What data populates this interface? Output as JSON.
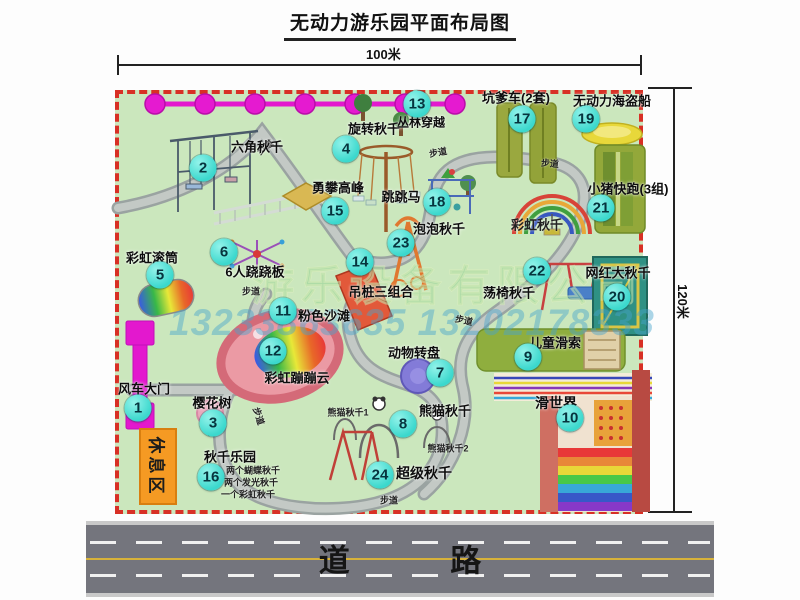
{
  "title": "无动力游乐园平面布局图",
  "dim": {
    "width": "100米",
    "height": "120米"
  },
  "road_label": "道 路",
  "rest_area_label": "休息区",
  "watermark": {
    "company": "游乐设备有限公司",
    "phone": "13233863635 13202178333"
  },
  "colors": {
    "map_bg": "#cbe7bd",
    "border_red": "#d83025",
    "badge": "#3bd8cd",
    "magenta": "#e318ce",
    "road": "#74757d",
    "rest_orange": "#f59a23",
    "path_gray": "#9aa3a1"
  },
  "markers": [
    {
      "num": "1",
      "name": "风车大门",
      "bx": 138,
      "by": 408,
      "lx": 144,
      "ly": 388
    },
    {
      "num": "2",
      "name": "六角秋千",
      "bx": 203,
      "by": 168,
      "lx": 257,
      "ly": 146
    },
    {
      "num": "3",
      "name": "樱花树",
      "bx": 213,
      "by": 423,
      "lx": 212,
      "ly": 402
    },
    {
      "num": "4",
      "name": "旋转秋千",
      "bx": 346,
      "by": 149,
      "lx": 374,
      "ly": 128
    },
    {
      "num": "5",
      "name": "彩虹滚筒",
      "bx": 160,
      "by": 275,
      "lx": 152,
      "ly": 257
    },
    {
      "num": "6",
      "name": "6人跷跷板",
      "bx": 224,
      "by": 252,
      "lx": 255,
      "ly": 271
    },
    {
      "num": "7",
      "name": "动物转盘",
      "bx": 440,
      "by": 373,
      "lx": 414,
      "ly": 352
    },
    {
      "num": "8",
      "name": "熊猫秋千",
      "bx": 403,
      "by": 424,
      "lx": 445,
      "ly": 410
    },
    {
      "num": "9",
      "name": "儿童滑索",
      "bx": 528,
      "by": 357,
      "lx": 555,
      "ly": 342
    },
    {
      "num": "10",
      "name": "滑世界",
      "bx": 570,
      "by": 418,
      "lx": 556,
      "ly": 403,
      "fs": 14
    },
    {
      "num": "11",
      "name": "粉色沙滩",
      "bx": 283,
      "by": 311,
      "lx": 324,
      "ly": 315
    },
    {
      "num": "12",
      "name": "彩虹蹦蹦云",
      "bx": 273,
      "by": 351,
      "lx": 297,
      "ly": 377
    },
    {
      "num": "13",
      "name": "丛林穿越",
      "bx": 417,
      "by": 104,
      "lx": 421,
      "ly": 122,
      "fs": 12
    },
    {
      "num": "14",
      "name": "吊桩三组合",
      "bx": 360,
      "by": 262,
      "lx": 381,
      "ly": 291
    },
    {
      "num": "15",
      "name": "勇攀高峰",
      "bx": 335,
      "by": 211,
      "lx": 338,
      "ly": 187
    },
    {
      "num": "16",
      "name": "秋千乐园",
      "bx": 211,
      "by": 477,
      "lx": 230,
      "ly": 456
    },
    {
      "num": "17",
      "name": "坑爹车(2套)",
      "bx": 522,
      "by": 119,
      "lx": 516,
      "ly": 97
    },
    {
      "num": "18",
      "name": "跳跳马",
      "bx": 437,
      "by": 202,
      "lx": 401,
      "ly": 196
    },
    {
      "num": "19",
      "name": "无动力海盗船",
      "bx": 586,
      "by": 119,
      "lx": 612,
      "ly": 100
    },
    {
      "num": "20",
      "name": "网红大秋千",
      "bx": 617,
      "by": 297,
      "lx": 618,
      "ly": 272
    },
    {
      "num": "21",
      "name": "小猪快跑(3组)",
      "bx": 601,
      "by": 208,
      "lx": 628,
      "ly": 188
    },
    {
      "num": "22",
      "name": "荡椅秋千",
      "bx": 537,
      "by": 271,
      "lx": 509,
      "ly": 292
    },
    {
      "num": "23",
      "name": "泡泡秋千",
      "bx": 401,
      "by": 243,
      "lx": 439,
      "ly": 228
    },
    {
      "num": "24",
      "name": "超级秋千",
      "bx": 380,
      "by": 475,
      "lx": 424,
      "ly": 473,
      "fs": 14
    }
  ],
  "labels": [
    {
      "text": "彩虹秋千",
      "x": 537,
      "y": 224,
      "fs": 13,
      "name": "label-rainbow-swing"
    },
    {
      "text": "熊猫秋千1",
      "x": 348,
      "y": 412,
      "fs": 9,
      "name": "label-panda-swing-1"
    },
    {
      "text": "熊猫秋千2",
      "x": 448,
      "y": 448,
      "fs": 9,
      "name": "label-panda-swing-2"
    },
    {
      "text": "两个蝴蝶秋千",
      "x": 253,
      "y": 470,
      "fs": 9,
      "name": "label-swing-note-1"
    },
    {
      "text": "两个发光秋千",
      "x": 251,
      "y": 482,
      "fs": 9,
      "name": "label-swing-note-2"
    },
    {
      "text": "一个彩虹秋千",
      "x": 248,
      "y": 494,
      "fs": 9,
      "name": "label-swing-note-3"
    },
    {
      "text": "步道",
      "x": 265,
      "y": 147,
      "fs": 9,
      "rot": -38,
      "name": "label-footpath"
    },
    {
      "text": "步道",
      "x": 438,
      "y": 152,
      "fs": 9,
      "rot": -10,
      "name": "label-footpath"
    },
    {
      "text": "步道",
      "x": 550,
      "y": 163,
      "fs": 9,
      "rot": 5,
      "name": "label-footpath"
    },
    {
      "text": "步道",
      "x": 251,
      "y": 291,
      "fs": 9,
      "rot": 0,
      "name": "label-footpath"
    },
    {
      "text": "步道",
      "x": 464,
      "y": 320,
      "fs": 9,
      "rot": 12,
      "name": "label-footpath"
    },
    {
      "text": "步道",
      "x": 389,
      "y": 500,
      "fs": 9,
      "rot": 0,
      "name": "label-footpath"
    },
    {
      "text": "步道",
      "x": 259,
      "y": 416,
      "fs": 9,
      "rot": 72,
      "name": "label-footpath"
    }
  ]
}
